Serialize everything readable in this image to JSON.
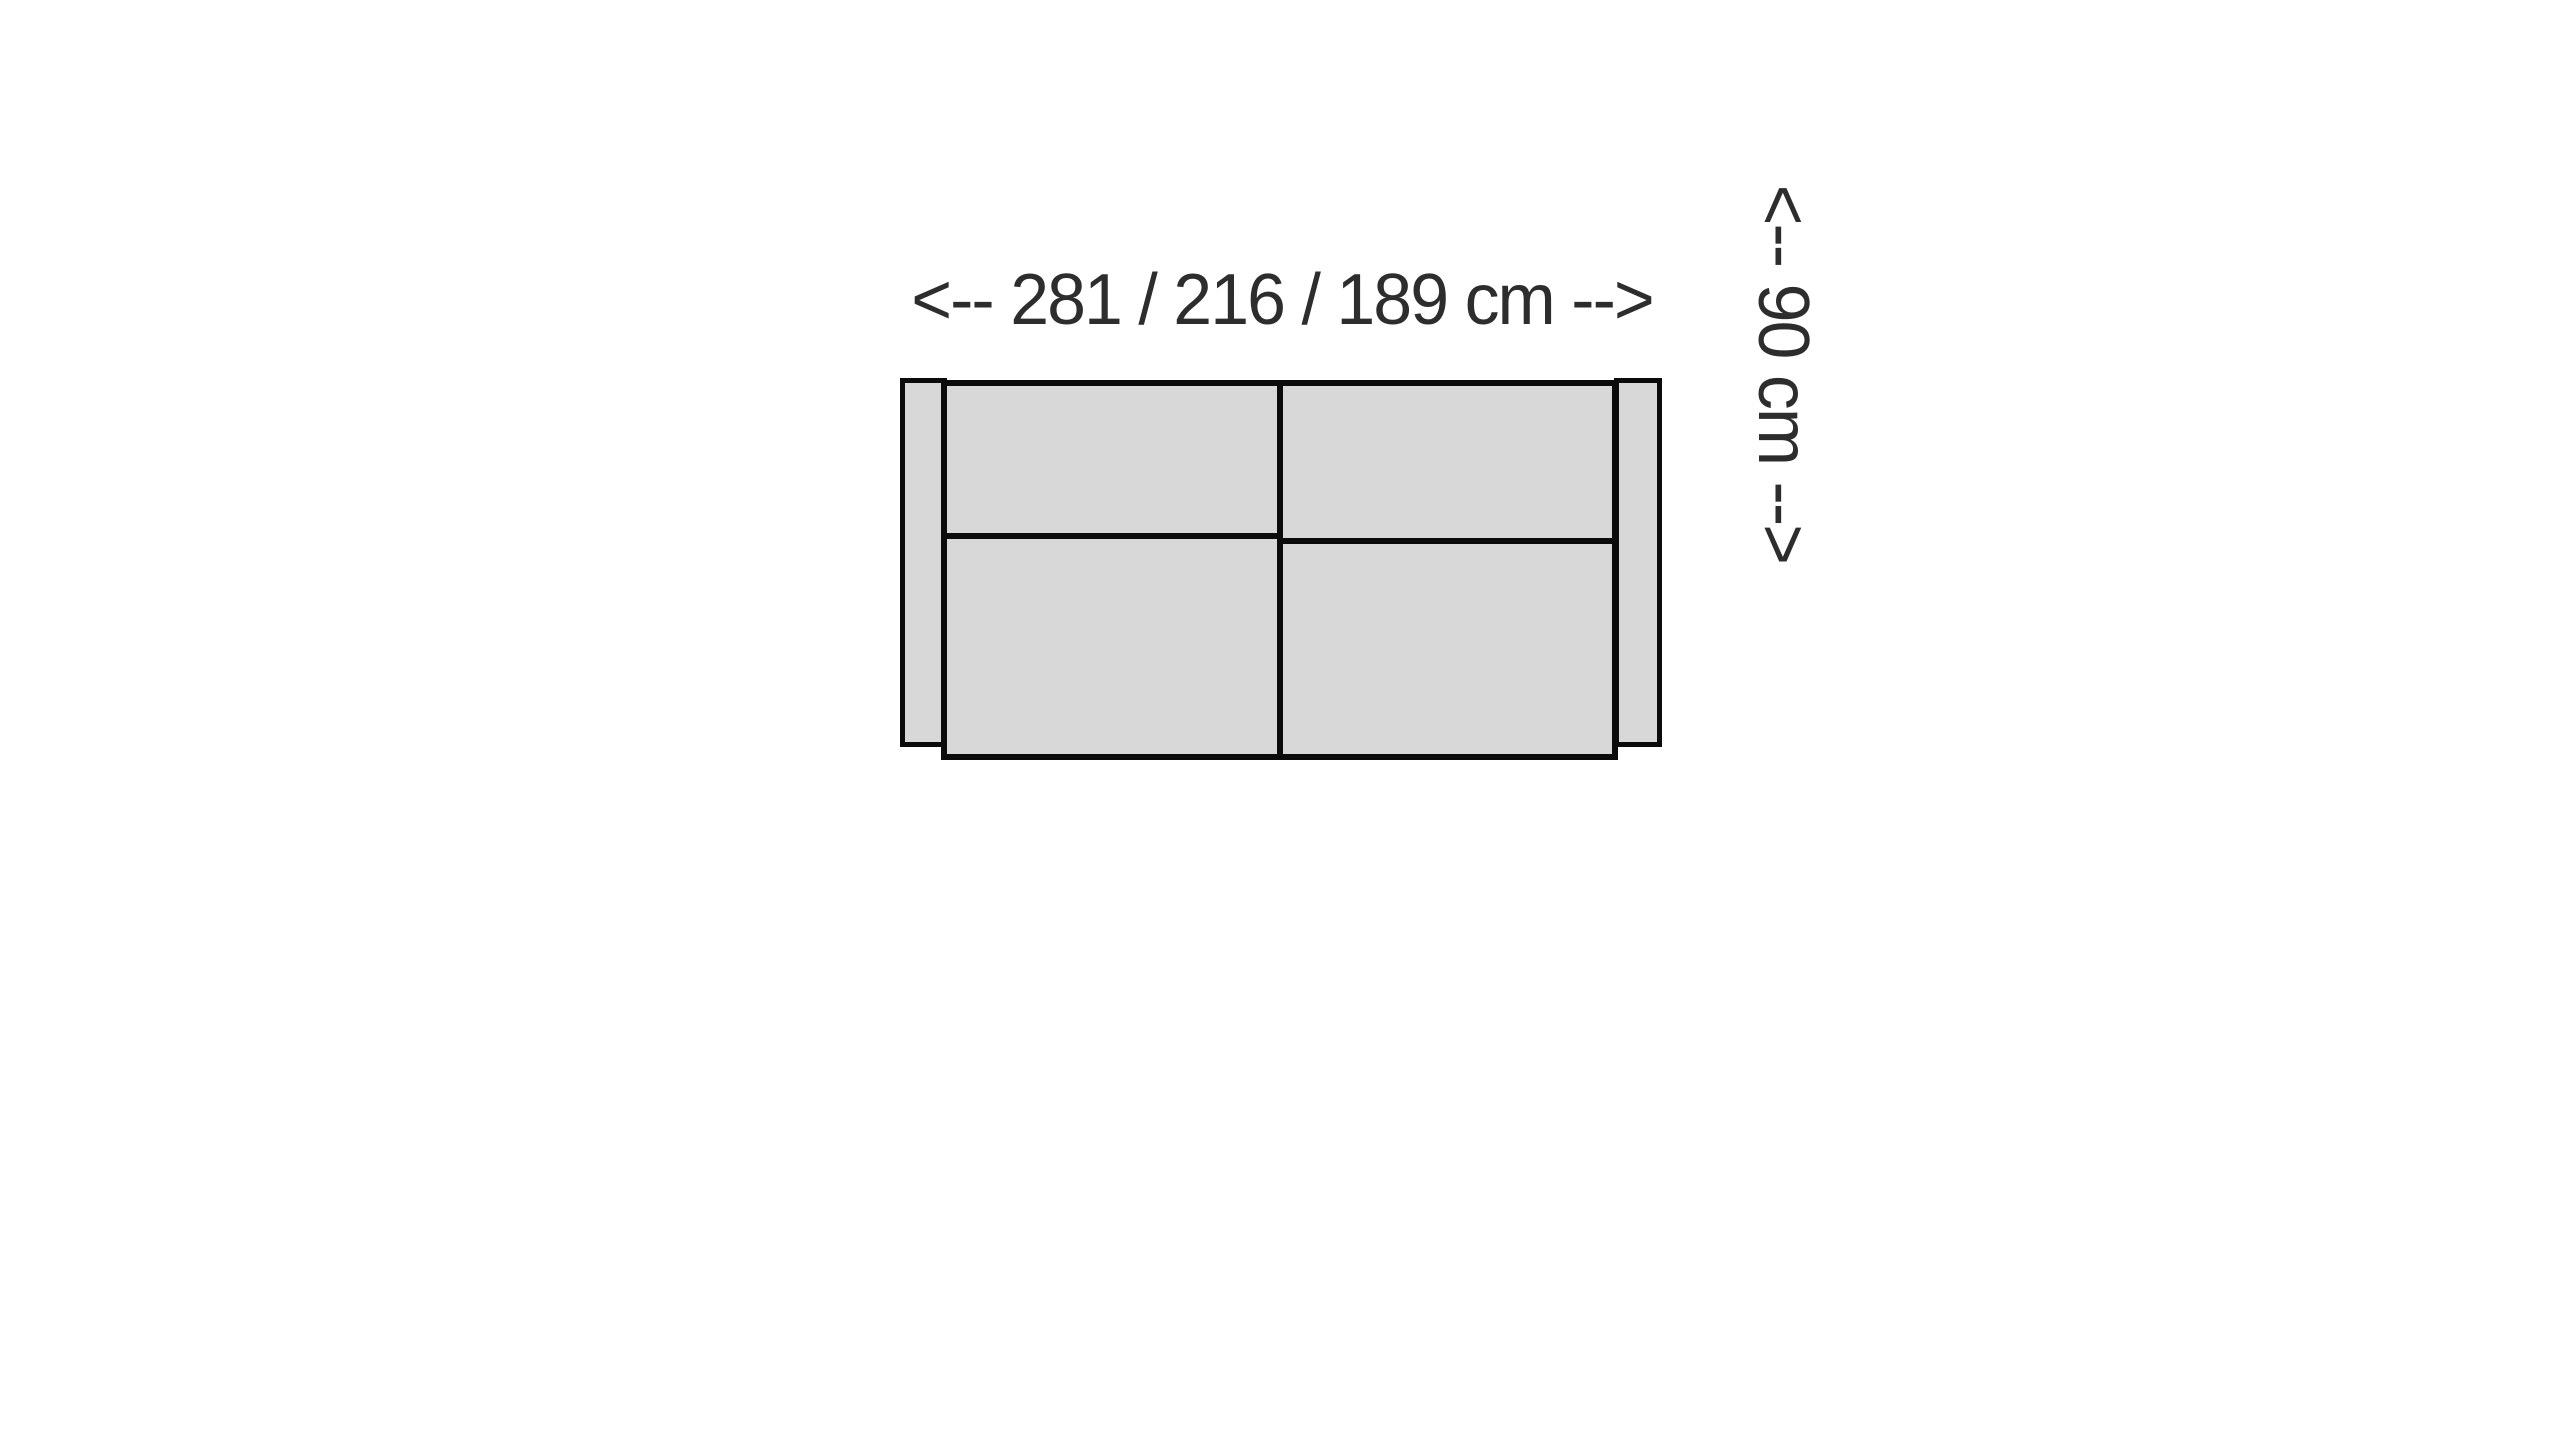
{
  "diagram": {
    "type": "sofa-top-view-dimension-diagram",
    "width_label": "<-- 281 / 216 / 189 cm -->",
    "depth_label": "<-- 90 cm -->",
    "width_options_cm": [
      281,
      216,
      189
    ],
    "depth_cm": 90,
    "unit": "cm",
    "colors": {
      "background": "#ffffff",
      "sofa_fill": "#d8d8d8",
      "outline": "#0b0b0b",
      "label_text": "#2d2d2d"
    }
  }
}
